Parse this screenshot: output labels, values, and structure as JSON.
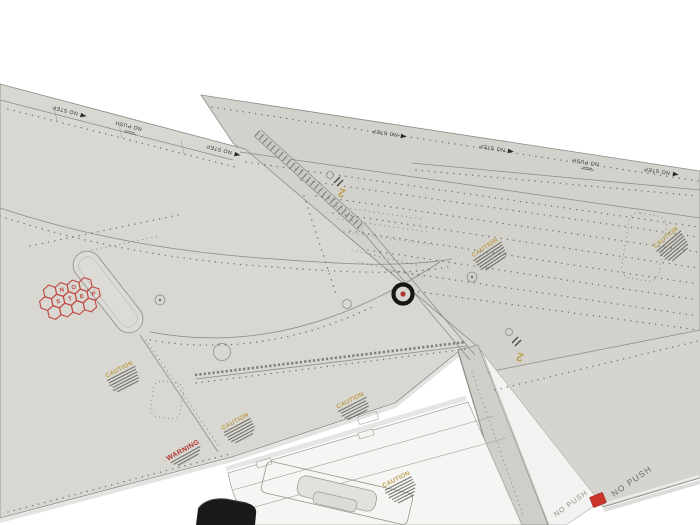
{
  "markings": {
    "no_step": "NO STEP",
    "no_push": "NO PUSH",
    "caution": "CAUTION",
    "warning": "WARNING",
    "panel_number": "2",
    "hex_no_step": {
      "row1": [
        "N",
        "O"
      ],
      "row2": [
        "S",
        "T",
        "E",
        "P"
      ]
    }
  },
  "colors": {
    "background": "#ffffff",
    "wing_gray": "#d8d7d2",
    "outer_panel_gray": "#d2d1cb",
    "aileron_gray": "#d5d4cf",
    "fairing_gray": "#cfcec8",
    "flap_white": "#f5f5f3",
    "stencil_yellow": "#bfa053",
    "stencil_red": "#b23430",
    "hex_red": "#c24741",
    "tab_red": "#cb3529",
    "panel_line": "#8b8a84",
    "black_part": "#191917"
  }
}
